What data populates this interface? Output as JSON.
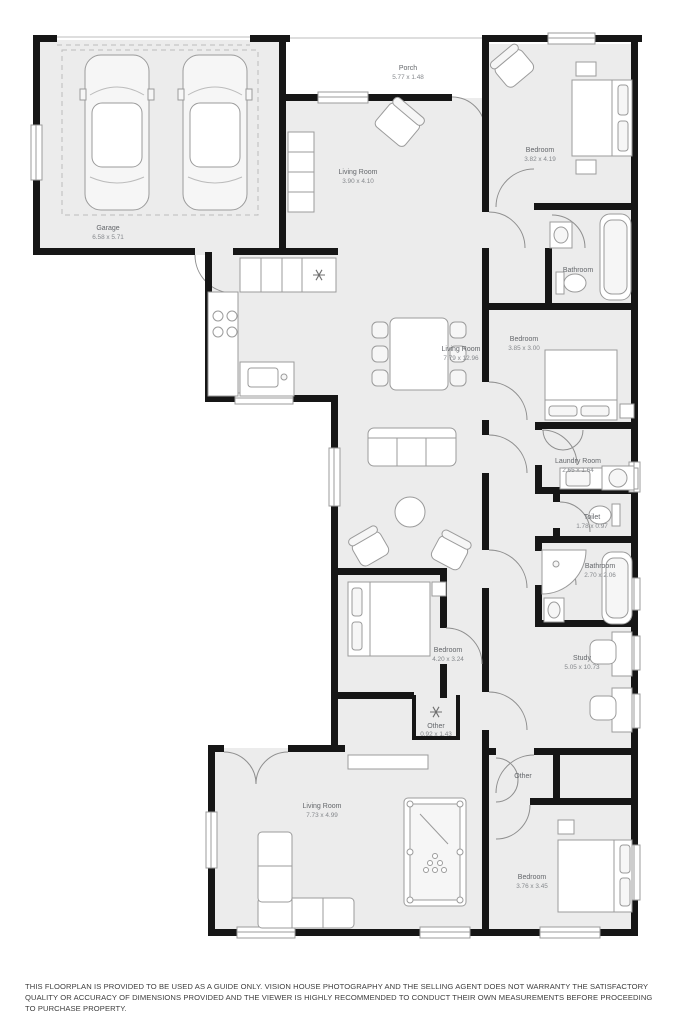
{
  "floorplan": {
    "rooms": {
      "porch": {
        "name": "Porch",
        "dims": "5.77 x 1.48"
      },
      "garage": {
        "name": "Garage",
        "dims": "6.58 x 5.71"
      },
      "living_top": {
        "name": "Living Room",
        "dims": "3.90 x 4.10"
      },
      "bedroom_top_right": {
        "name": "Bedroom",
        "dims": "3.82 x 4.19"
      },
      "bathroom_top": {
        "name": "Bathroom",
        "dims": ""
      },
      "bedroom_right": {
        "name": "Bedroom",
        "dims": "3.85 x 3.00"
      },
      "living_main": {
        "name": "Living Room",
        "dims": "7.79 x 12.96"
      },
      "laundry": {
        "name": "Laundry Room",
        "dims": "2.65 x 1.64"
      },
      "toilet": {
        "name": "Toilet",
        "dims": "1.78 x 0.97"
      },
      "bathroom_mid": {
        "name": "Bathroom",
        "dims": "2.70 x 2.06"
      },
      "study": {
        "name": "Study",
        "dims": "5.05 x 10.73"
      },
      "bedroom_mid_left": {
        "name": "Bedroom",
        "dims": "4.20 x 3.24"
      },
      "closet_ac": {
        "name": "Other",
        "dims": "0.92 x 1.43"
      },
      "living_bottom": {
        "name": "Living Room",
        "dims": "7.73 x 4.99"
      },
      "closet_hall": {
        "name": "Other",
        "dims": ""
      },
      "bedroom_bottom": {
        "name": "Bedroom",
        "dims": "3.76 x 3.45"
      }
    },
    "colors": {
      "wall": "#161616",
      "room_fill": "#ececec",
      "furniture_stroke": "#9b9b9b",
      "label": "#63666a"
    }
  },
  "footer": {
    "disclaimer": "THIS FLOORPLAN IS PROVIDED TO BE USED AS A GUIDE ONLY. VISION HOUSE PHOTOGRAPHY AND THE SELLING AGENT DOES NOT WARRANTY THE SATISFACTORY QUALITY OR ACCURACY OF DIMENSIONS PROVIDED AND THE VIEWER IS HIGHLY RECOMMENDED TO CONDUCT THEIR OWN MEASUREMENTS BEFORE PROCEEDING TO PURCHASE PROPERTY."
  }
}
